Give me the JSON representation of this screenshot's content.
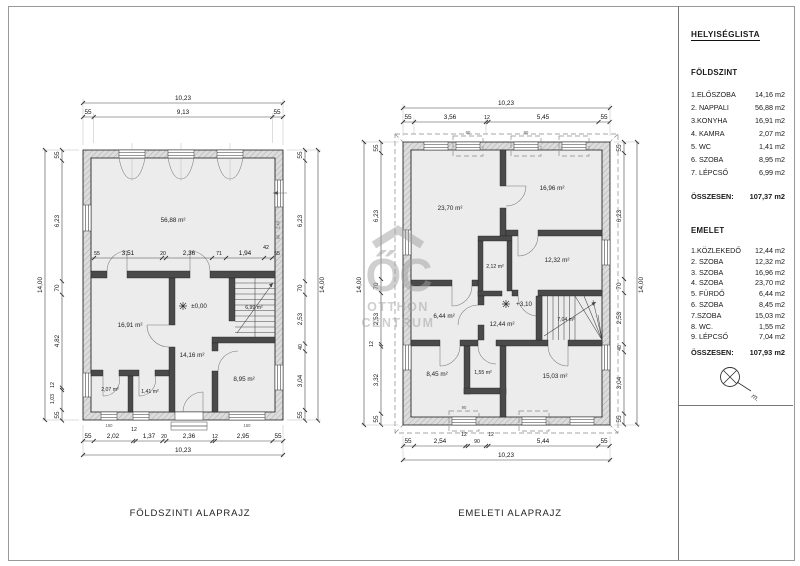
{
  "sheet": {
    "titles": {
      "ground": "FÖLDSZINTI ALAPRAJZ",
      "upper": "EMELETI ALAPRAJZ"
    }
  },
  "sidebar": {
    "title": "HELYISÉGLISTA",
    "ground": {
      "heading": "FÖLDSZINT",
      "rows": [
        [
          "1.ELŐSZOBA",
          "14,16 m2"
        ],
        [
          "2. NAPPALI",
          "56,88 m2"
        ],
        [
          "3.KONYHA",
          "16,91 m2"
        ],
        [
          "4. KAMRA",
          "2,07 m2"
        ],
        [
          "5. WC",
          "1,41 m2"
        ],
        [
          "6. SZOBA",
          "8,95 m2"
        ],
        [
          "7. LÉPCSŐ",
          "6,99 m2"
        ]
      ],
      "total_label": "ÖSSZESEN:",
      "total": "107,37 m2"
    },
    "upper": {
      "heading": "EMELET",
      "rows": [
        [
          "1.KÖZLEKEDŐ",
          "12,44 m2"
        ],
        [
          "2. SZOBA",
          "12,32 m2"
        ],
        [
          "3. SZOBA",
          "16,96 m2"
        ],
        [
          "4. SZOBA",
          "23,70 m2"
        ],
        [
          "5. FÜRDŐ",
          "6,44 m2"
        ],
        [
          "6. SZOBA",
          "8,45 m2"
        ],
        [
          "7.SZOBA",
          "15,03 m2"
        ],
        [
          "8. WC.",
          "1,55 m2"
        ],
        [
          "9. LÉPCSŐ",
          "7,04 m2"
        ]
      ],
      "total_label": "ÖSSZESEN:",
      "total": "107,93 m2"
    },
    "north_mark": "m."
  },
  "watermark": {
    "oc": "ŐC",
    "line1": "OTTHON",
    "line2": "CENTRUM"
  },
  "ground": {
    "level": "±0,00",
    "rooms": {
      "nappali": "56,88 m²",
      "konyha": "16,91 m²",
      "eloszoba": "14,16 m²",
      "lepcso": "6,99 m²",
      "szoba": "8,95 m²",
      "kamra": "2,07 m²",
      "wc": "1,41 m²"
    },
    "dims": {
      "top_total": "10,23",
      "top": [
        "55",
        "9,13",
        "55"
      ],
      "bottom": [
        "55",
        "2,02",
        "12",
        "1,37",
        "20",
        "2,36",
        "12",
        "2,95",
        "55"
      ],
      "bottom_total": "10,23",
      "left_total": "14,00",
      "left": [
        "55",
        "6,23",
        "70",
        "4,82",
        "12",
        "1,03",
        "55"
      ],
      "right": [
        "55",
        "6,23",
        "70",
        "2,53",
        "40",
        "3,04",
        "55"
      ],
      "right_total": "14,00",
      "inner": [
        "55",
        "3,51",
        "20",
        "2,36",
        "71",
        "1,94",
        "42",
        "55"
      ]
    },
    "tags": {
      "door": "90",
      "window": "150",
      "height": "2,40"
    }
  },
  "upper": {
    "level": "+3,10",
    "rooms": {
      "szoba4": "23,70 m²",
      "szoba3": "16,96 m²",
      "szoba2": "12,32 m²",
      "gardrob": "2,12 m²",
      "kozlekedo": "12,44 m²",
      "furdo": "6,44 m²",
      "szoba6": "8,45 m²",
      "wc": "1,55 m²",
      "szoba7": "15,03 m²",
      "lepcso": "7,04 m²"
    },
    "dims": {
      "top_total": "10,23",
      "top": [
        "55",
        "3,56",
        "12",
        "5,45",
        "55"
      ],
      "bottom": [
        "55",
        "2,54",
        "12",
        "90",
        "12",
        "5,44",
        "55"
      ],
      "bottom_total": "10,23",
      "left_total": "14,00",
      "left": [
        "55",
        "6,23",
        "70",
        "2,53",
        "12",
        "3,32",
        "55"
      ],
      "right": [
        "55",
        "6,23",
        "70",
        "2,53",
        "40",
        "3,04",
        "55"
      ],
      "right_total": "14,00"
    },
    "tags": {
      "window": "90"
    }
  }
}
